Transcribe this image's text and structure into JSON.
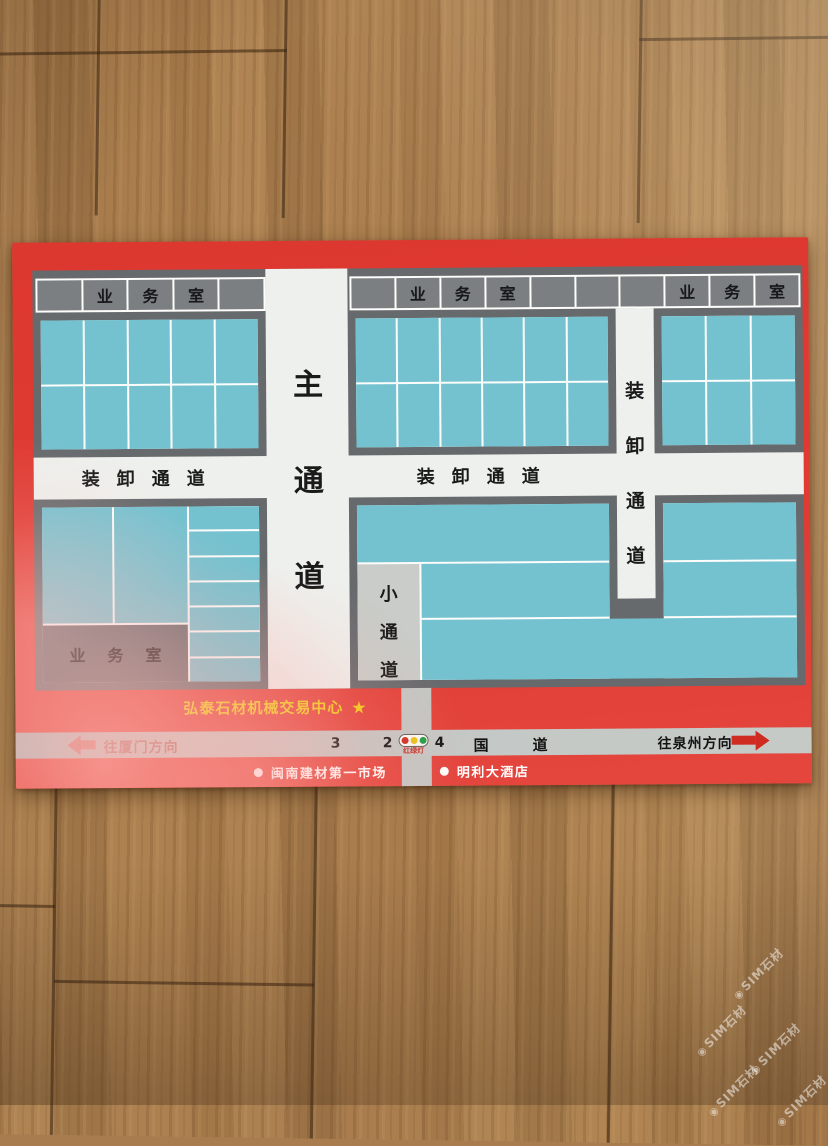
{
  "poster": {
    "title": "弘泰石材机械交易中心",
    "star": "★",
    "map": {
      "header_left": [
        "",
        "业",
        "务",
        "室",
        ""
      ],
      "header_right": [
        "",
        "业",
        "务",
        "室",
        "",
        "",
        "",
        "业",
        "务",
        "室"
      ],
      "main_road": "主通道",
      "loading_road_left": "装卸通道",
      "loading_road_right": "装卸通道",
      "loading_road_vertical": "装卸通道",
      "small_road": "小通道",
      "office_box": "业务室"
    },
    "road": {
      "to_xiamen": "往厦门方向",
      "to_quanzhou": "往泉州方向",
      "marker_3": "3",
      "marker_2": "2",
      "marker_4": "4",
      "national_road": "国道",
      "traffic_light_label": "红绿灯"
    },
    "landmarks": [
      {
        "bullet": "●",
        "label": "闽南建材第一市场"
      },
      {
        "bullet": "●",
        "label": "明利大酒店"
      }
    ],
    "colors": {
      "poster_red": "#e03b33",
      "stall_teal": "#74c2d0",
      "panel_gray": "#666a6d",
      "header_gray": "#7b7f82",
      "road_white": "#eef0ed",
      "band_gray": "#c3c7c4",
      "title_yellow": "#f2cf15",
      "traffic_red": "#cf2b20",
      "traffic_yellow": "#e8c618",
      "traffic_green": "#1f9e46"
    }
  },
  "watermark": {
    "logo": "◉",
    "text": "SIM石材"
  }
}
